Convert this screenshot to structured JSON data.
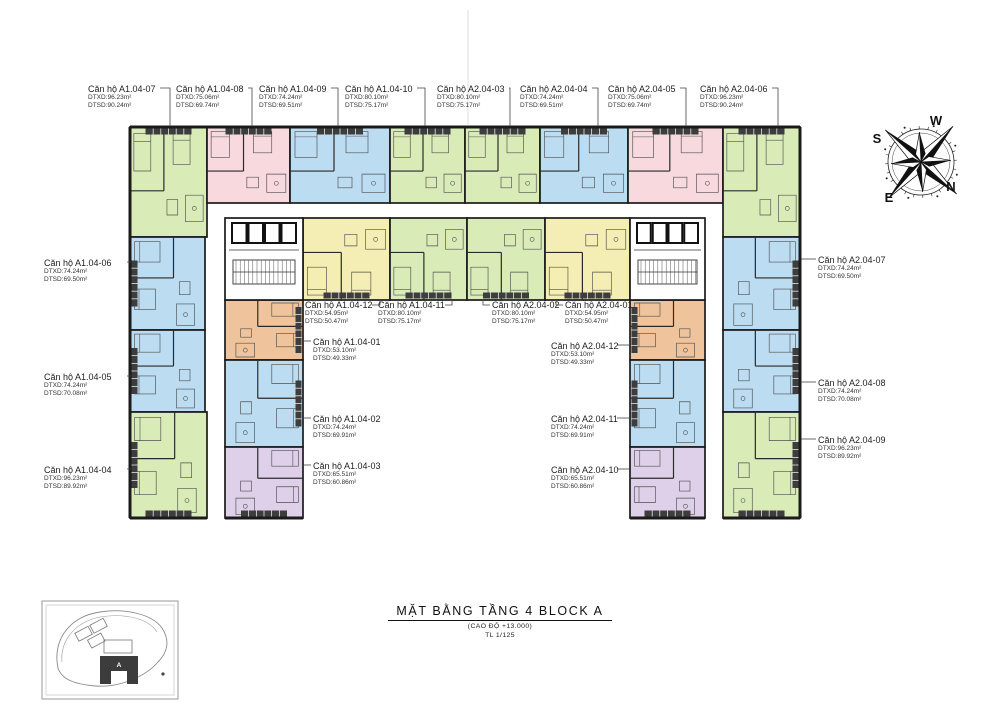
{
  "drawing": {
    "title": "MẶT BẰNG TẦNG 4 BLOCK A",
    "elevation_note": "(CAO ĐỘ +13.000)",
    "scale_note": "TL 1/125"
  },
  "compass": {
    "n": "N",
    "e": "E",
    "s": "S",
    "w": "W"
  },
  "site_plan": {
    "block_label": "A"
  },
  "palette": {
    "green": "#d9ecb8",
    "pink": "#f7d9de",
    "blue": "#bcdcf2",
    "yellow": "#f5eeb4",
    "orange": "#efc49d",
    "purple": "#ded0e8",
    "wall": "#1b1b1b",
    "balcony": "#3d3d3d"
  },
  "units": [
    {
      "id": "A1.04-07",
      "name": "Căn hộ A1.04-07",
      "dtxd": "DTXD:96.23m²",
      "dtsd": "DTSD:90.24m²",
      "color": "green"
    },
    {
      "id": "A1.04-08",
      "name": "Căn hộ A1.04-08",
      "dtxd": "DTXD:75.06m²",
      "dtsd": "DTSD:69.74m²",
      "color": "pink"
    },
    {
      "id": "A1.04-09",
      "name": "Căn hộ A1.04-09",
      "dtxd": "DTXD:74.24m²",
      "dtsd": "DTSD:69.51m²",
      "color": "blue"
    },
    {
      "id": "A1.04-10",
      "name": "Căn hộ A1.04-10",
      "dtxd": "DTXD:80.10m²",
      "dtsd": "DTSD:75.17m²",
      "color": "green"
    },
    {
      "id": "A2.04-03",
      "name": "Căn hộ A2.04-03",
      "dtxd": "DTXD:80.10m²",
      "dtsd": "DTSD:75.17m²",
      "color": "green"
    },
    {
      "id": "A2.04-04",
      "name": "Căn hộ A2.04-04",
      "dtxd": "DTXD:74.24m²",
      "dtsd": "DTSD:69.51m²",
      "color": "blue"
    },
    {
      "id": "A2.04-05",
      "name": "Căn hộ A2.04-05",
      "dtxd": "DTXD:75.06m²",
      "dtsd": "DTSD:69.74m²",
      "color": "pink"
    },
    {
      "id": "A2.04-06",
      "name": "Căn hộ A2.04-06",
      "dtxd": "DTXD:96.23m²",
      "dtsd": "DTSD:90.24m²",
      "color": "green"
    },
    {
      "id": "A1.04-06",
      "name": "Căn hộ A1.04-06",
      "dtxd": "DTXD:74.24m²",
      "dtsd": "DTSD:69.50m²",
      "color": "blue"
    },
    {
      "id": "A1.04-05",
      "name": "Căn hộ A1.04-05",
      "dtxd": "DTXD:74.24m²",
      "dtsd": "DTSD:70.08m²",
      "color": "blue"
    },
    {
      "id": "A1.04-04",
      "name": "Căn hộ A1.04-04",
      "dtxd": "DTXD:96.23m²",
      "dtsd": "DTSD:89.92m²",
      "color": "green"
    },
    {
      "id": "A2.04-07",
      "name": "Căn hộ A2.04-07",
      "dtxd": "DTXD:74.24m²",
      "dtsd": "DTSD:69.50m²",
      "color": "blue"
    },
    {
      "id": "A2.04-08",
      "name": "Căn hộ A2.04-08",
      "dtxd": "DTXD:74.24m²",
      "dtsd": "DTSD:70.08m²",
      "color": "blue"
    },
    {
      "id": "A2.04-09",
      "name": "Căn hộ A2.04-09",
      "dtxd": "DTXD:96.23m²",
      "dtsd": "DTSD:89.92m²",
      "color": "green"
    },
    {
      "id": "A1.04-12",
      "name": "Căn hộ A1.04-12",
      "dtxd": "DTXD:54.95m²",
      "dtsd": "DTSD:50.47m²",
      "color": "yellow"
    },
    {
      "id": "A1.04-11",
      "name": "Căn hộ A1.04-11",
      "dtxd": "DTXD:80.10m²",
      "dtsd": "DTSD:75.17m²",
      "color": "green"
    },
    {
      "id": "A2.04-02",
      "name": "Căn hộ A2.04-02",
      "dtxd": "DTXD:80.10m²",
      "dtsd": "DTSD:75.17m²",
      "color": "green"
    },
    {
      "id": "A2.04-01",
      "name": "Căn hộ A2.04-01",
      "dtxd": "DTXD:54.95m²",
      "dtsd": "DTSD:50.47m²",
      "color": "yellow"
    },
    {
      "id": "A1.04-01",
      "name": "Căn hộ A1.04-01",
      "dtxd": "DTXD:53.10m²",
      "dtsd": "DTSD:49.33m²",
      "color": "orange"
    },
    {
      "id": "A1.04-02",
      "name": "Căn hộ A1.04-02",
      "dtxd": "DTXD:74.24m²",
      "dtsd": "DTSD:69.91m²",
      "color": "blue"
    },
    {
      "id": "A1.04-03",
      "name": "Căn hộ A1.04-03",
      "dtxd": "DTXD:65.51m²",
      "dtsd": "DTSD:60.86m²",
      "color": "purple"
    },
    {
      "id": "A2.04-12",
      "name": "Căn hộ A2.04-12",
      "dtxd": "DTXD:53.10m²",
      "dtsd": "DTSD:49.33m²",
      "color": "orange"
    },
    {
      "id": "A2.04-11",
      "name": "Căn hộ A2.04-11",
      "dtxd": "DTXD:74.24m²",
      "dtsd": "DTSD:69.91m²",
      "color": "blue"
    },
    {
      "id": "A2.04-10",
      "name": "Căn hộ A2.04-10",
      "dtxd": "DTXD:65.51m²",
      "dtsd": "DTSD:60.86m²",
      "color": "purple"
    }
  ]
}
